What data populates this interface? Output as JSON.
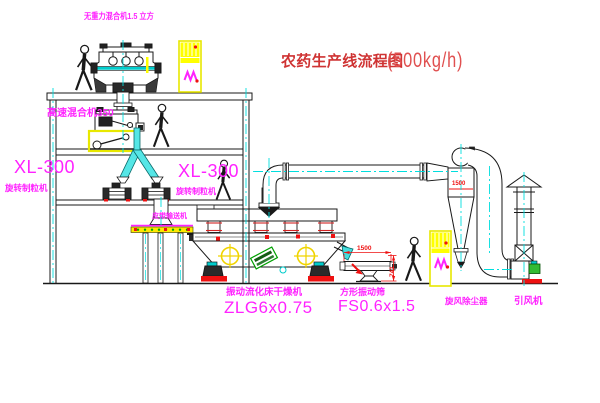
{
  "title": {
    "text": "农药生产线流程图",
    "capacity": "(500kg/h)"
  },
  "equipment": {
    "gravity_mixer": {
      "label": "无重力混合机1.5 立方"
    },
    "high_speed_mixer": {
      "label": "高速混合机350"
    },
    "granulator_left": {
      "model": "XL-300",
      "name": "旋转制粒机"
    },
    "granulator_right": {
      "model": "XL-300",
      "name": "旋转制粒机"
    },
    "belt_conveyor": {
      "name": "皮带输送机"
    },
    "fluid_bed_dryer": {
      "name": "振动流化床干燥机",
      "model": "ZLG6x0.75"
    },
    "vibrating_sieve": {
      "name": "方形振动筛",
      "model": "FS0.6x1.5"
    },
    "cyclone": {
      "name": "旋风除尘器",
      "body_dim": "1500"
    },
    "fan": {
      "name": "引风机"
    }
  },
  "dimensions": {
    "sieve_length": "1500",
    "sieve_height": "741"
  },
  "colors": {
    "label_magenta": "#ff22ff",
    "title_red": "#cf3333",
    "dimension_red": "#ee1111",
    "centerline_cyan": "#00dede",
    "highlight_yellow": "#ffff00",
    "nameplate_green": "#00a000"
  }
}
